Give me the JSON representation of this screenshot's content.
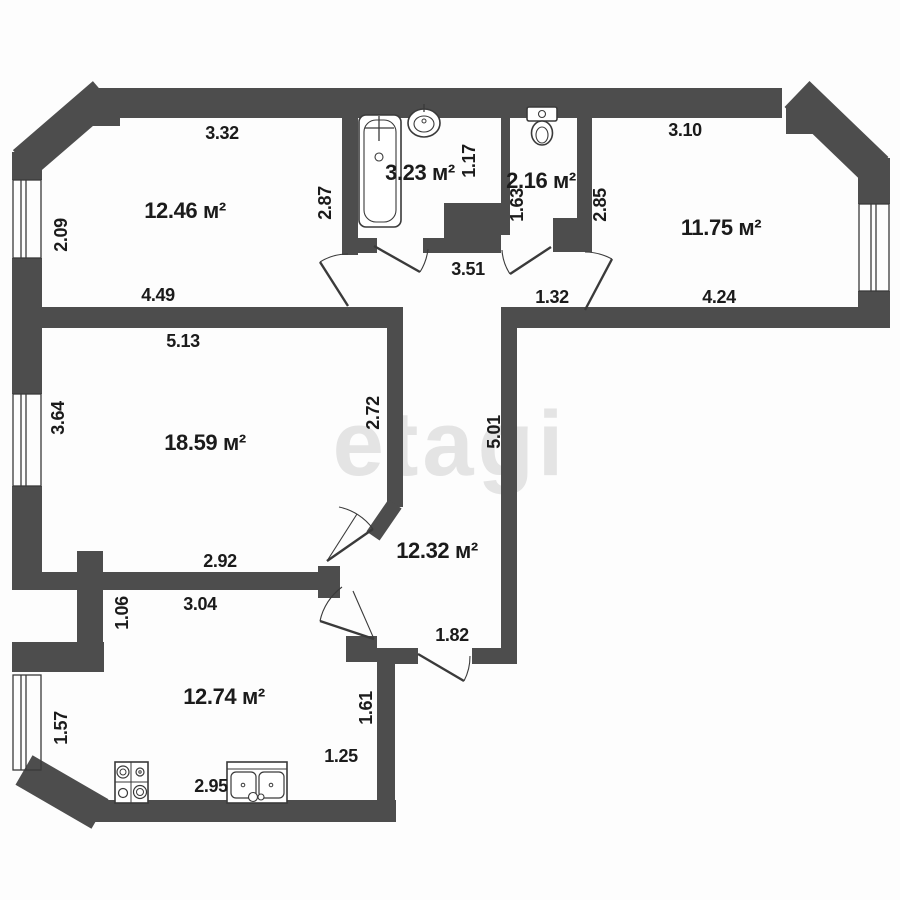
{
  "colors": {
    "wall": "#4d4d4d",
    "line": "#3a3a3a",
    "text": "#1b1b1b",
    "background": "#fdfdfd",
    "watermark": "#e4e4e4"
  },
  "watermark": "etagi",
  "rooms": [
    {
      "id": "room-top-left",
      "area": "12.46 м²"
    },
    {
      "id": "bathroom",
      "area": "3.23 м²"
    },
    {
      "id": "wc",
      "area": "2.16 м²"
    },
    {
      "id": "room-top-right",
      "area": "11.75 м²"
    },
    {
      "id": "living-room",
      "area": "18.59 м²"
    },
    {
      "id": "hallway",
      "area": "12.32 м²"
    },
    {
      "id": "kitchen",
      "area": "12.74 м²"
    }
  ],
  "dims": [
    "3.32",
    "3.10",
    "2.09",
    "2.87",
    "1.17",
    "1.63",
    "2.85",
    "4.49",
    "3.51",
    "1.32",
    "4.24",
    "5.13",
    "3.64",
    "2.72",
    "5.01",
    "2.92",
    "3.04",
    "1.06",
    "1.82",
    "1.57",
    "1.61",
    "1.25",
    "2.95"
  ],
  "icons": [
    "bathtub-icon",
    "wash-basin-icon",
    "toilet-icon",
    "stove-icon",
    "kitchen-sink-icon"
  ]
}
